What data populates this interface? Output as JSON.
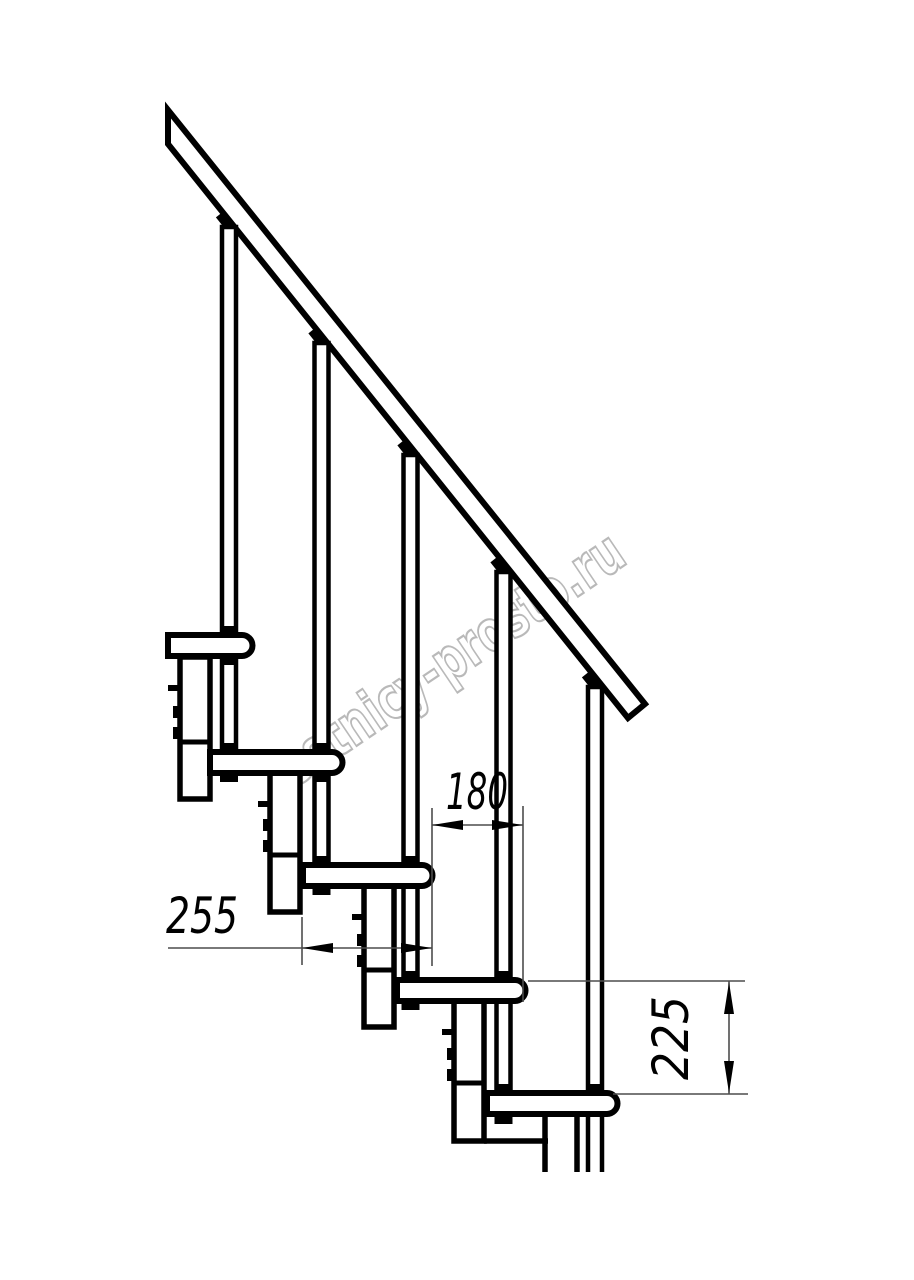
{
  "drawing": {
    "subject": "staircase-side-elevation",
    "dimensions": {
      "going": {
        "value": "180"
      },
      "tread_depth": {
        "value": "255"
      },
      "rise": {
        "value": "225"
      }
    }
  },
  "watermark": {
    "text": "lestnicy-prosto.ru"
  },
  "colors": {
    "line": "#000000",
    "dim": "#4d4d4d",
    "watermark": "#b9b9b9",
    "background": "#ffffff"
  }
}
